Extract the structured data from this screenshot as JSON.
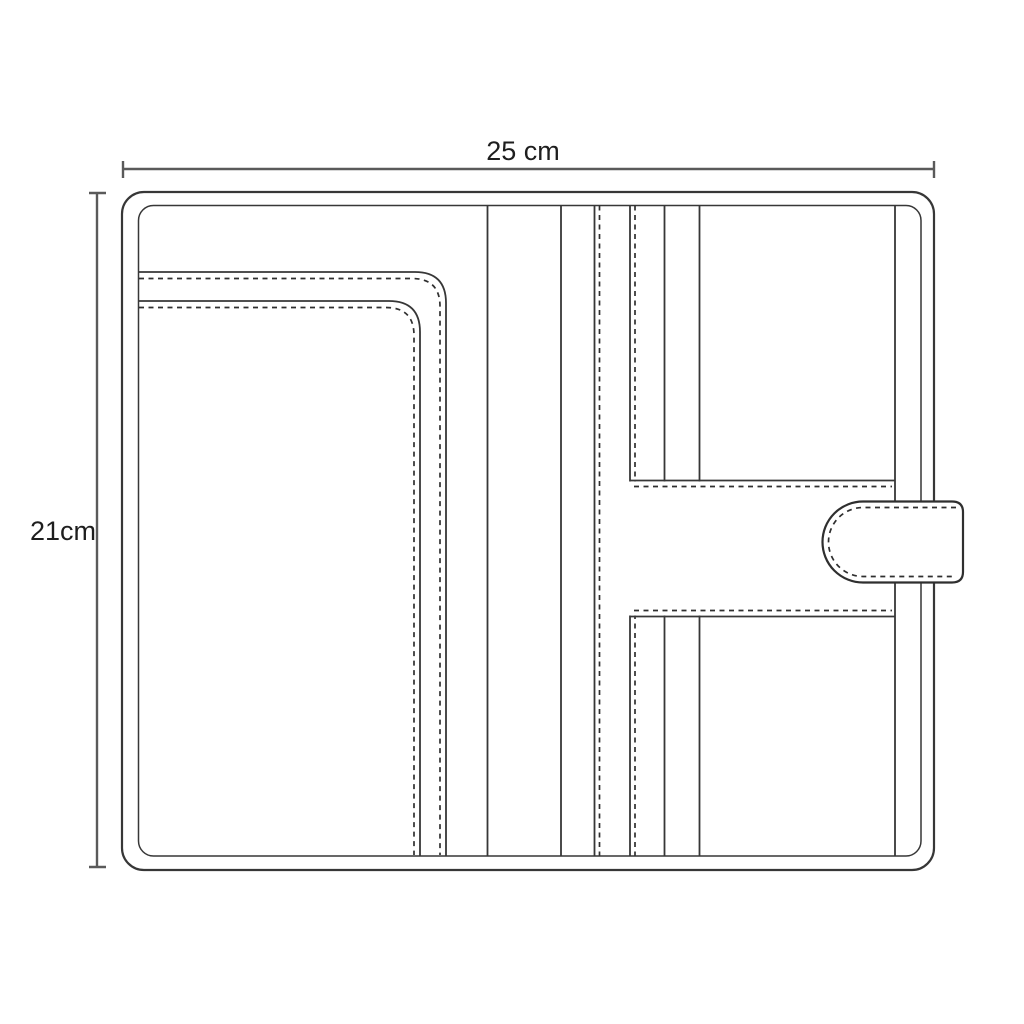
{
  "page": {
    "background": "#ffffff",
    "title": "Notebook cover sewing pattern diagram"
  },
  "diagram": {
    "width_dimension": {
      "label": "25 cm",
      "value_cm": 25
    },
    "height_dimension": {
      "label": "21cm",
      "value_cm": 21
    },
    "colors": {
      "outline": "#373737",
      "stitching": "#2f2f2f",
      "dimension_lines": "#5a5a5a",
      "label_text": "#1e1e1e",
      "fill": "#ffffff"
    }
  }
}
